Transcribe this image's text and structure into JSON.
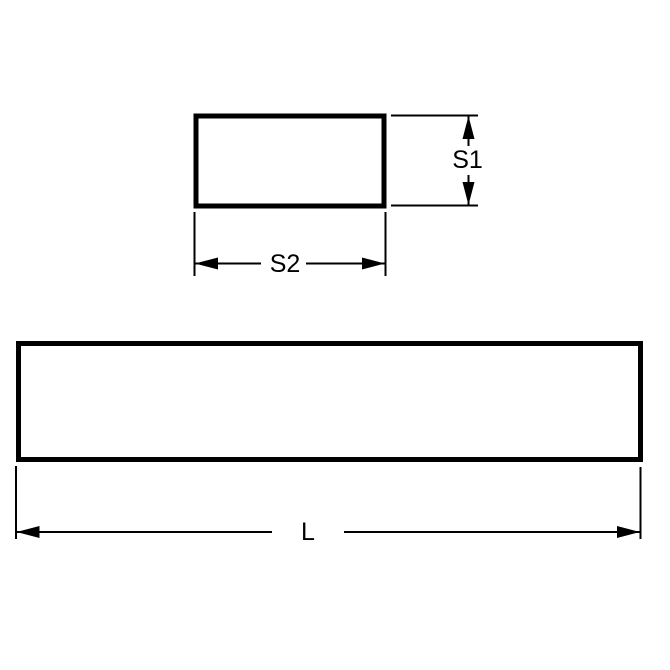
{
  "colors": {
    "line": "#000000",
    "background": "#ffffff"
  },
  "labels": {
    "s1": "S1",
    "s2": "S2",
    "l": "L"
  }
}
